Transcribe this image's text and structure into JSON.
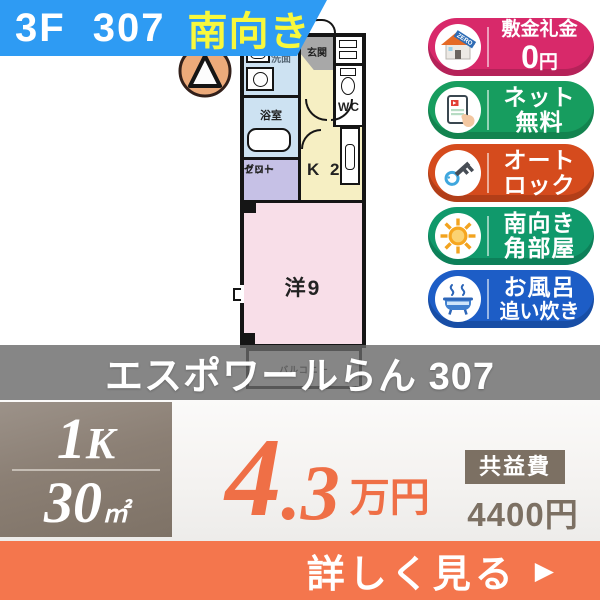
{
  "banner": {
    "room": "3F 307",
    "direction": "南向き"
  },
  "floorplan": {
    "entrance": "玄関",
    "washroom": "洗面",
    "bathroom": "浴室",
    "wc": "WC",
    "kitchen": "K 2",
    "closet1": "クロー",
    "closet2": "ゼット",
    "main_room": "洋9",
    "balcony": "バルコニー"
  },
  "badges": [
    {
      "name": "deposit-key-money-zero",
      "line1": "敷金礼金",
      "num": "0",
      "unit": "円",
      "ribbon": "ZERO",
      "color": "#d8296a"
    },
    {
      "name": "free-internet",
      "line1": "ネット",
      "line2": "無料",
      "color": "#179d5f"
    },
    {
      "name": "auto-lock",
      "line1": "オート",
      "line2": "ロック",
      "color": "#d54b1d"
    },
    {
      "name": "south-corner-room",
      "line1": "南向き",
      "line2": "角部屋",
      "color": "#10996b"
    },
    {
      "name": "bath-reheating",
      "line1": "お風呂",
      "line2": "追い炊き",
      "color": "#1d5dc6"
    }
  ],
  "property_name": "エスポワールらん 307",
  "summary": {
    "layout_num": "1",
    "layout_letter": "K",
    "area_num": "30",
    "area_unit": "㎡",
    "rent_int": "4",
    "rent_dec": ".3",
    "rent_unit": "万円",
    "fee_label": "共益費",
    "fee_value": "4400円"
  },
  "cta": {
    "label": "詳しく見る",
    "arrow": "▶"
  },
  "colors": {
    "banner_blue": "#2e9bf3",
    "highlight_yellow": "#f8f83c",
    "price_orange": "#ef6f46",
    "cta_orange": "#f4764d",
    "fee_taupe": "#7c7063",
    "band_gray": "rgba(104,104,104,0.8)"
  }
}
